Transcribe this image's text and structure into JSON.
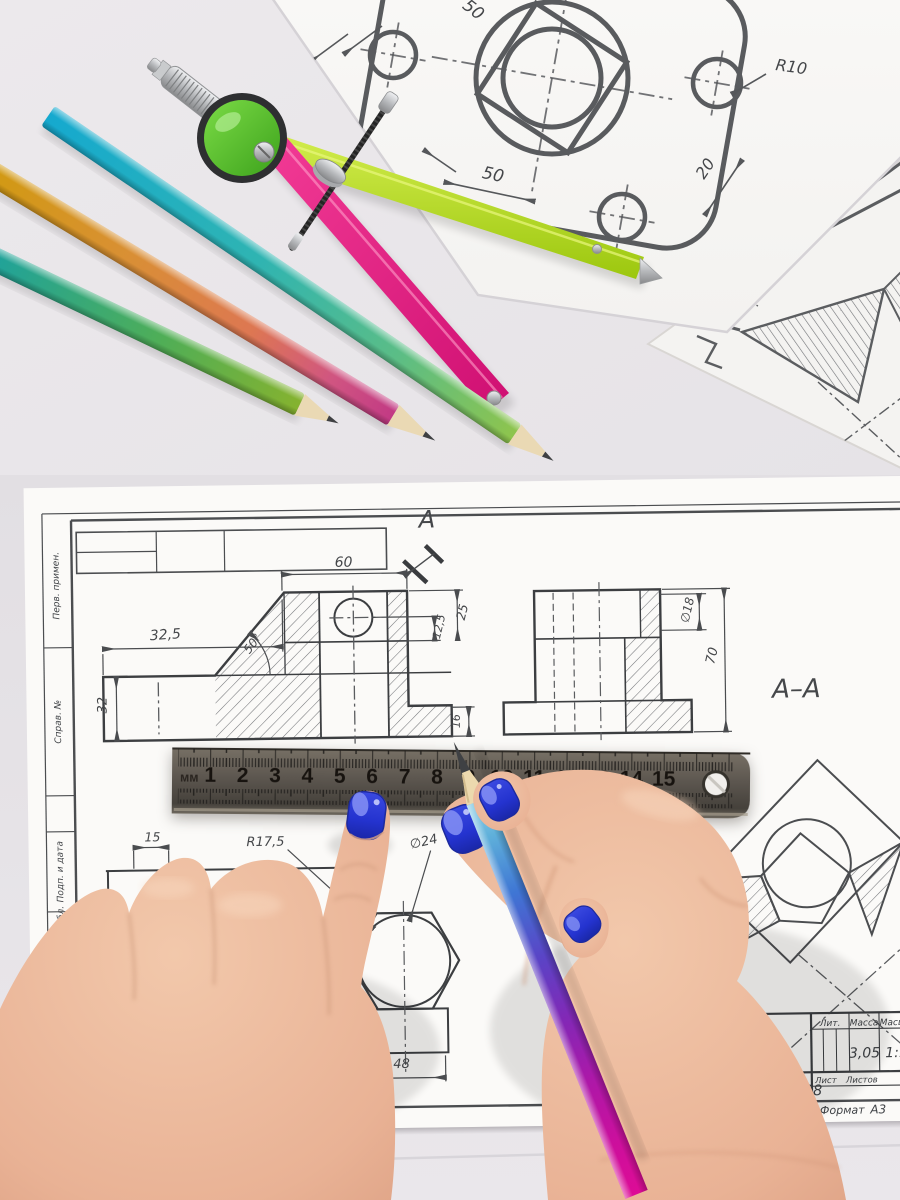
{
  "scene": {
    "table_color": "#eae7ec",
    "paper_color": "#faf9f7",
    "line_color": "#4b4d50",
    "compass_pink": "#e81a7e",
    "compass_lime": "#b8d428",
    "compass_green": "#54c832",
    "nail_polish": "#2a38d4"
  },
  "top_sheet": {
    "dim_50_top": "50",
    "dim_50_bottom": "50",
    "dim_r10": "R10",
    "dim_20": "20"
  },
  "main_sheet": {
    "section_arrow_label": "A",
    "section_title": "A–A",
    "front_view": {
      "width": "60",
      "left_width": "32,5",
      "depth": "12,5",
      "top_height": "25",
      "left_height": "32",
      "step_height": "16",
      "chamfer_angle": "50°"
    },
    "side_view": {
      "hole_dia": "∅18",
      "height": "70"
    },
    "bottom_view": {
      "offset": "15",
      "radius": "R17,5",
      "hex_dia": "∅24",
      "width": "48"
    },
    "margin_labels": [
      "Перв. примен.",
      "Справ. №",
      "Подп. и дата",
      "Инв. № дубл.",
      "Взам. инв. №",
      "Подп. и дата"
    ],
    "title_block": {
      "name": "Деталь",
      "material": "Сталь 10 ГОСТ 1050-88",
      "lit": "Лит.",
      "mass": "Масса",
      "scale": "Масштаб",
      "mass_value": "3,05",
      "scale_value": "1:1",
      "sheet": "Лист",
      "sheets": "Листов",
      "copied": "Копировал",
      "format_label": "Формат",
      "format_value": "А3"
    }
  },
  "ruler": {
    "unit": "мм",
    "numbers": [
      "1",
      "2",
      "3",
      "4",
      "5",
      "6",
      "7",
      "8",
      "9",
      "10",
      "11",
      "12",
      "13",
      "14",
      "15"
    ]
  }
}
